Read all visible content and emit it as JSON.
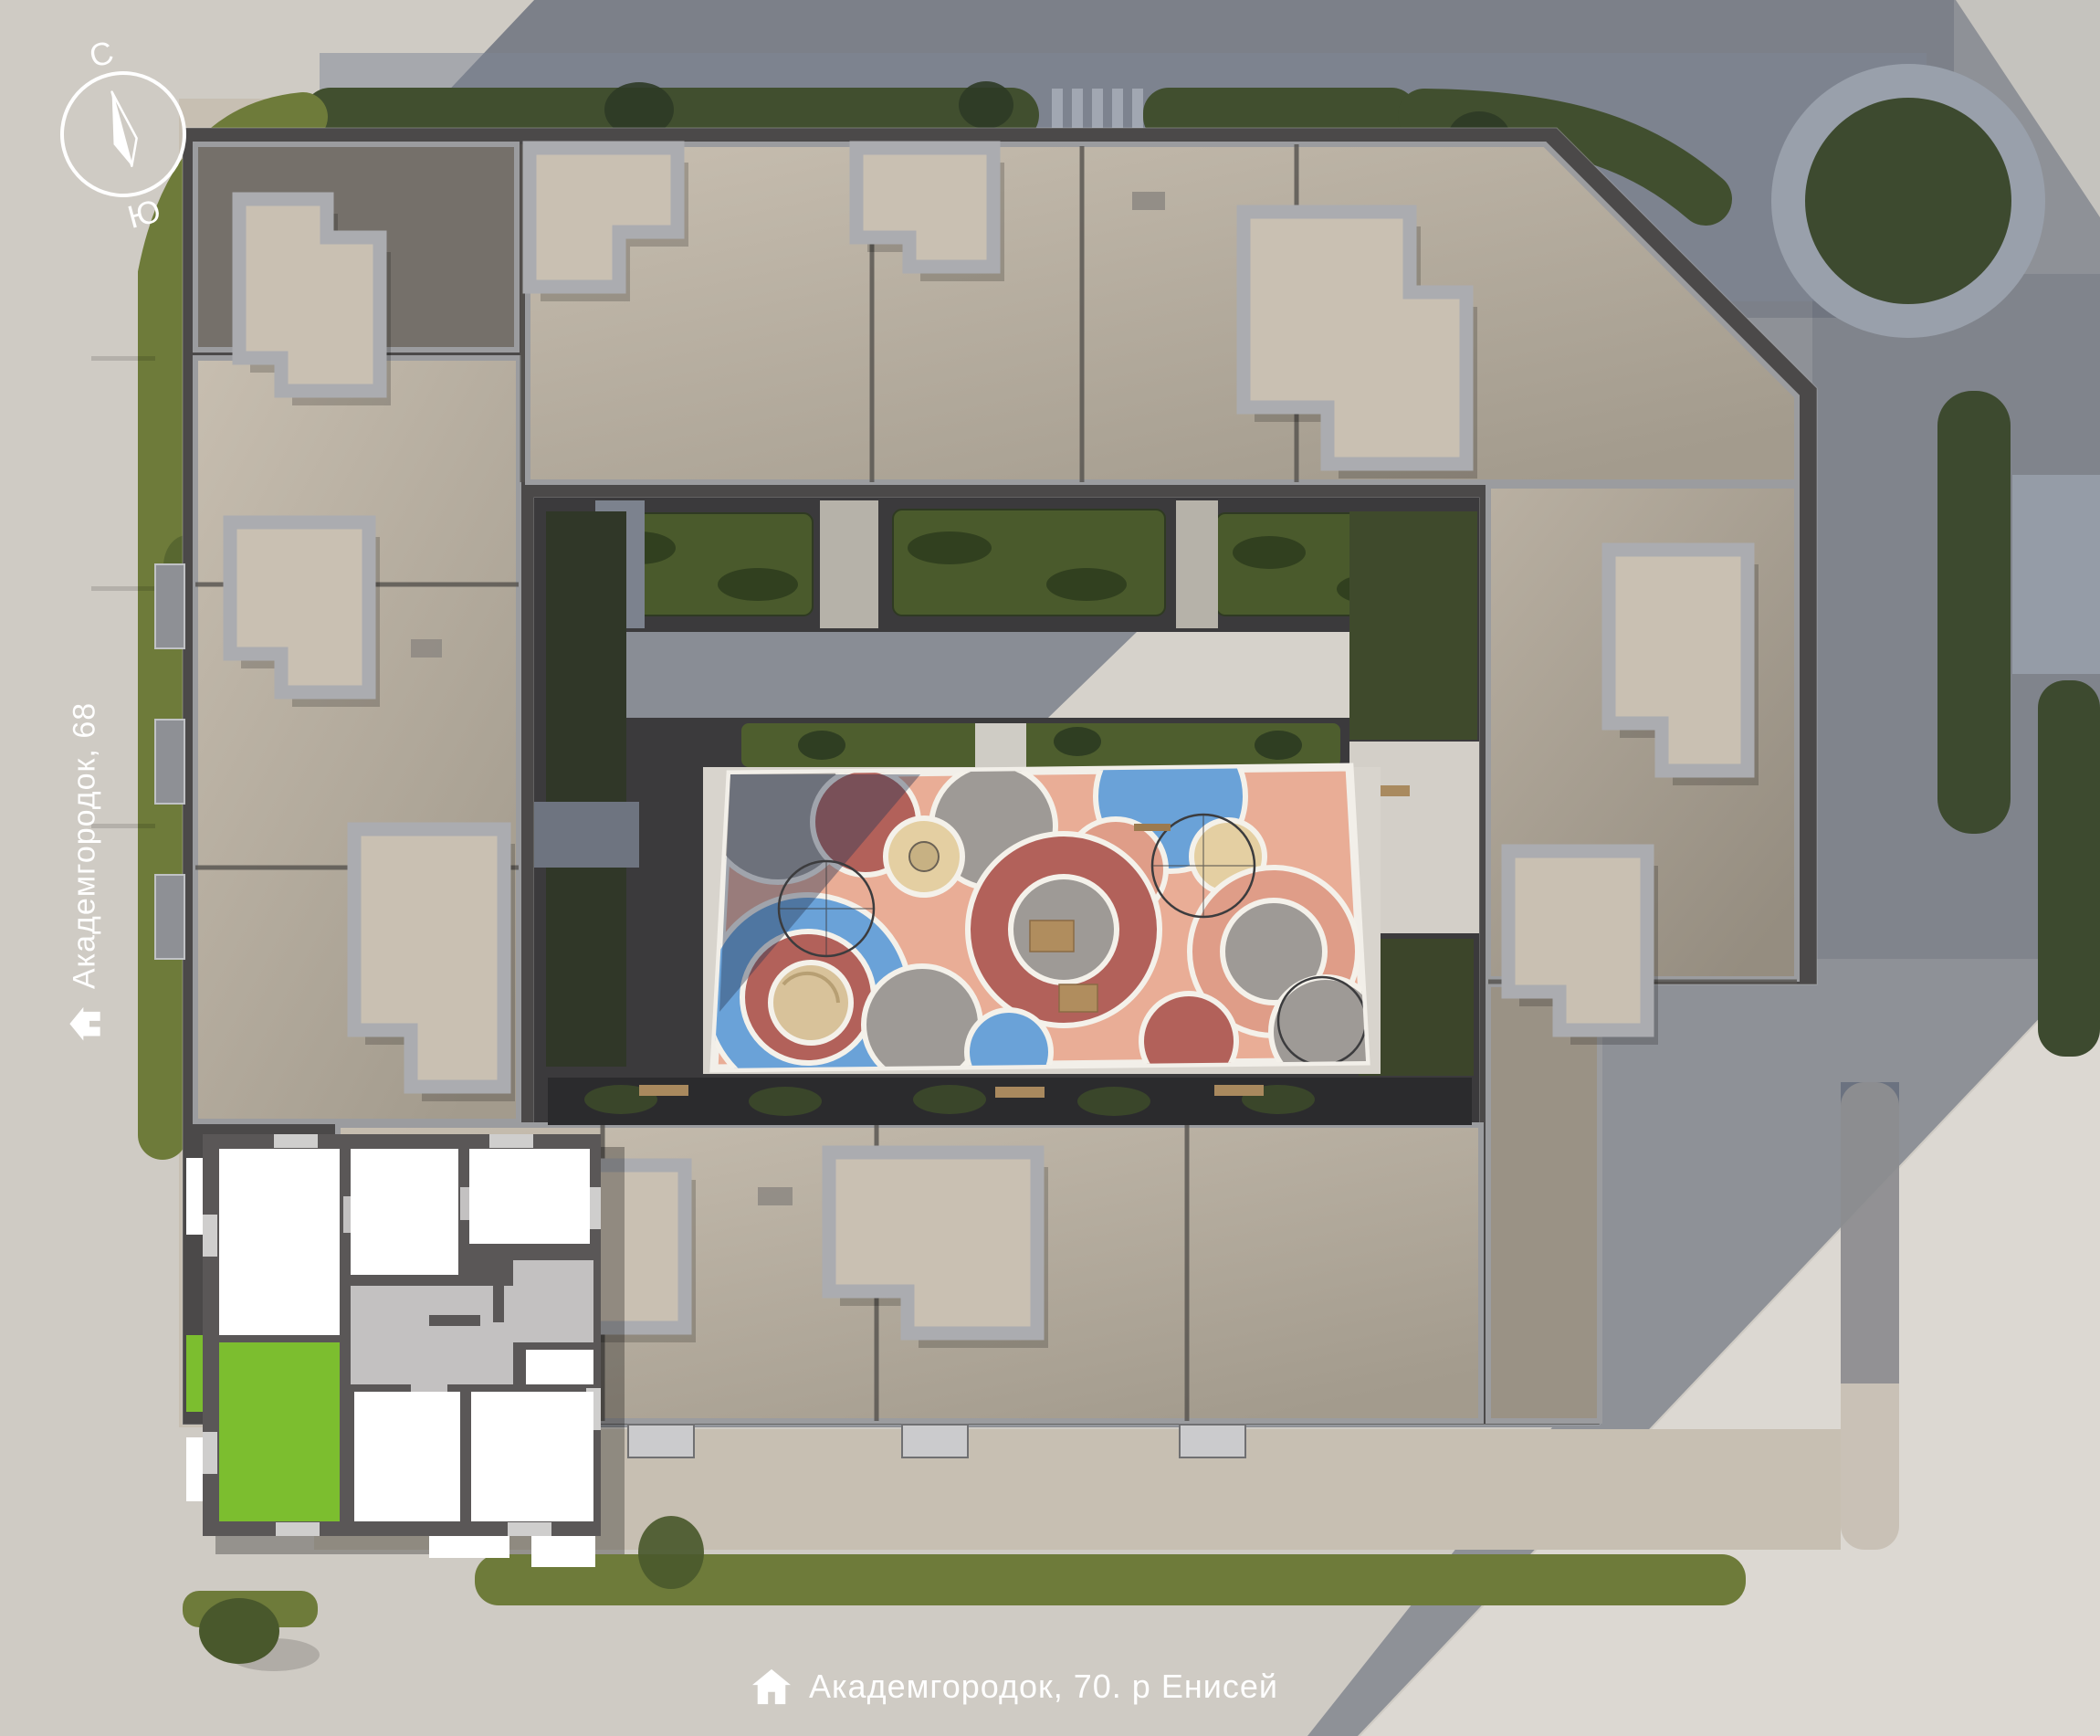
{
  "compass": {
    "north_label": "С",
    "south_label": "Ю"
  },
  "street_labels": {
    "left": {
      "text": "Академгородок, 68"
    },
    "bottom": {
      "text": "Академгородок, 70. р Енисей"
    }
  },
  "floor_plan": {
    "selected_unit_color": "#7CBE2F"
  },
  "colors": {
    "label_text": "#FFFFFF",
    "accent_green": "#7CBE2F",
    "playground_salmon": "#E9AD96",
    "playground_brick": "#B2615A",
    "playground_blue": "#6AA2D8",
    "playground_gray": "#9E9A96",
    "playground_cream": "#E4CFA2"
  }
}
